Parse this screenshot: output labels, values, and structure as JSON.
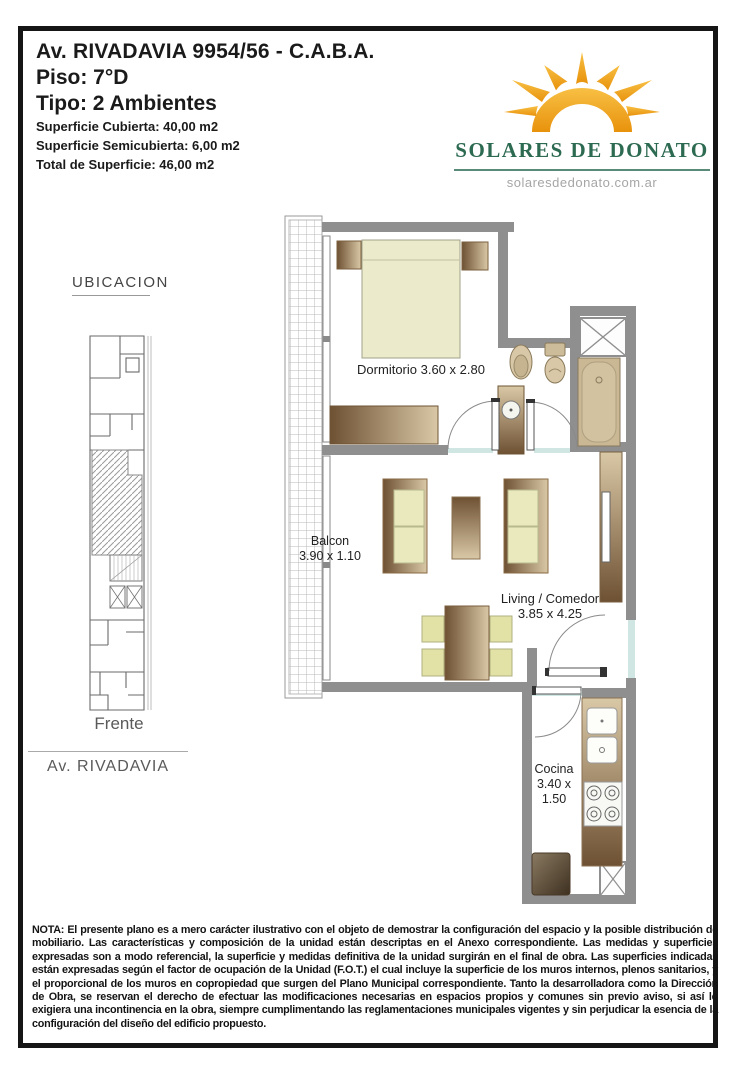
{
  "page": {
    "border_color": "#151515",
    "background": "#ffffff"
  },
  "header": {
    "title": "Av. RIVADAVIA 9954/56 - C.A.B.A.",
    "floor": "Piso: 7°D",
    "unit_type": "Tipo: 2 Ambientes",
    "surface_covered": "Superficie Cubierta: 40,00 m2",
    "surface_semicovered": "Superficie Semicubierta: 6,00 m2",
    "surface_total": "Total de Superficie: 46,00 m2"
  },
  "brand": {
    "name": "SOLARES DE DONATO",
    "website": "solaresdedonato.com.ar",
    "green": "#2d6a52",
    "sun_orange": "#efa01e"
  },
  "location_panel": {
    "heading": "UBICACION",
    "front_label": "Frente",
    "street_label": "Av. RIVADAVIA"
  },
  "floor_plan": {
    "wall_color": "#8f8f8f",
    "rooms": {
      "dormitorio": {
        "label": "Dormitorio 3.60 x 2.80"
      },
      "balcon": {
        "name": "Balcon",
        "dims": "3.90 x 1.10"
      },
      "living": {
        "name": "Living / Comedor",
        "dims": "3.85 x 4.25"
      },
      "cocina": {
        "name": "Cocina",
        "dims_line1": "3.40 x",
        "dims_line2": "1.50"
      }
    }
  },
  "note": {
    "text": "NOTA: El presente plano es a mero carácter ilustrativo con el objeto de demostrar la configuración del espacio y la posible distribución de mobiliario. Las características y composición de la unidad están descriptas en el Anexo correspondiente. Las medidas y superficies expresadas son a modo referencial, la superficie y medidas definitiva de la unidad surgirán en el final de obra. Las superficies indicadas están expresadas según el factor de ocupación de la Unidad (F.O.T.) el cual incluye la superficie de los muros internos, plenos sanitarios, y el proporcional de los muros en copropiedad que surgen del Plano Municipal correspondiente. Tanto la desarrolladora como la Dirección de Obra, se reservan el derecho de efectuar las modificaciones necesarias en espacios propios y comunes sin previo aviso, si así lo exigiera una incontinencia en la obra, siempre cumplimentando las reglamentaciones municipales vigentes y sin perjudicar la esencia de la configuración del diseño del edificio propuesto."
  }
}
